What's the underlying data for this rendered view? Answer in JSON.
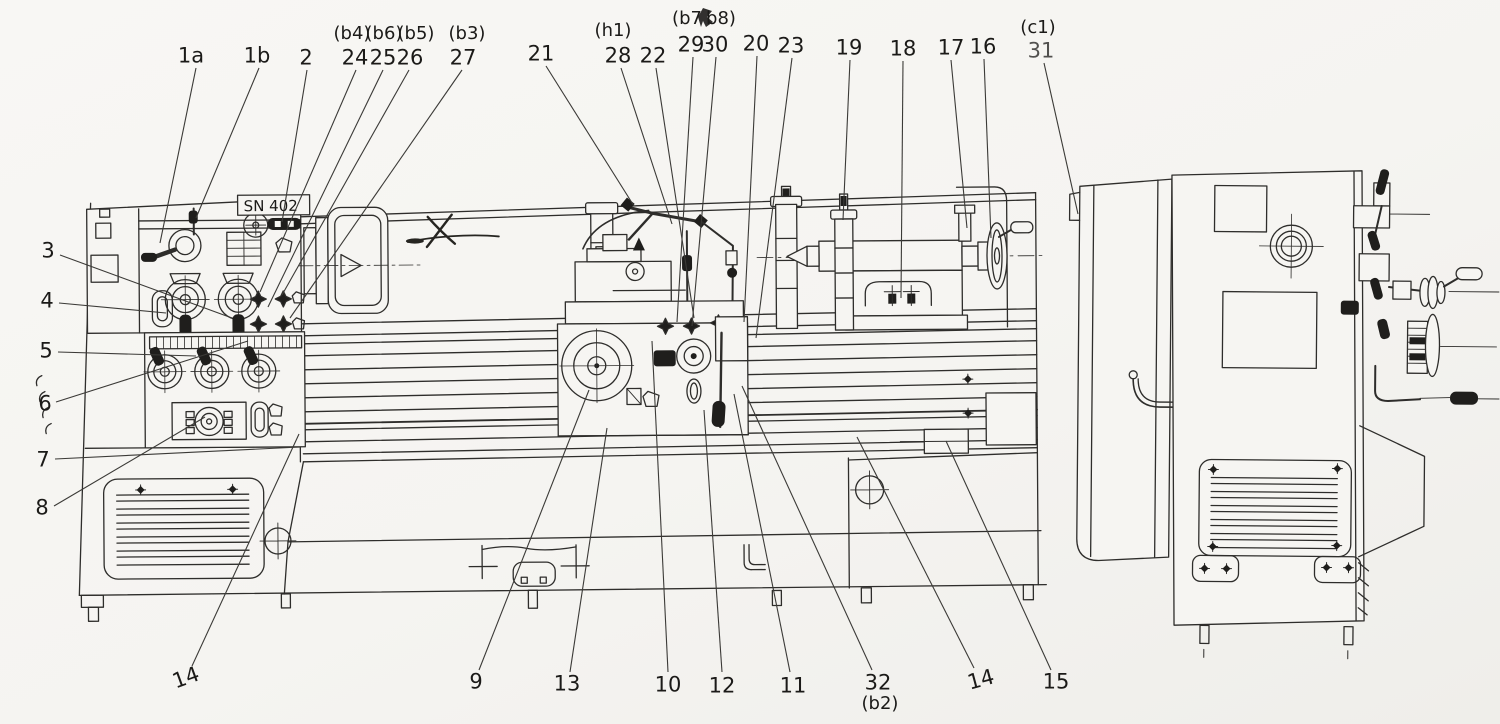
{
  "document": {
    "model_label": "SN 402"
  },
  "figure": {
    "paper_color": "#f6f5f2",
    "line_color": "#2e2d2b",
    "views": [
      "front-view",
      "end-view"
    ]
  },
  "callouts": [
    {
      "id": "1a",
      "text": "1a",
      "x": 191,
      "y": 56,
      "leader": [
        196,
        68,
        160,
        243
      ]
    },
    {
      "id": "1b",
      "text": "1b",
      "x": 257,
      "y": 56,
      "leader": [
        259,
        68,
        196,
        218
      ]
    },
    {
      "id": "2",
      "text": "2",
      "x": 306,
      "y": 58,
      "leader": [
        307,
        70,
        282,
        222
      ]
    },
    {
      "id": "b4",
      "text": "(b4)",
      "x": 352,
      "y": 34,
      "size": "sm"
    },
    {
      "id": "b6",
      "text": "(b6)",
      "x": 384,
      "y": 34,
      "size": "sm"
    },
    {
      "id": "b5",
      "text": "(b5)",
      "x": 416,
      "y": 34,
      "size": "sm"
    },
    {
      "id": "24",
      "text": "24",
      "x": 355,
      "y": 58,
      "leader": [
        356,
        70,
        260,
        292
      ]
    },
    {
      "id": "25",
      "text": "25",
      "x": 383,
      "y": 58,
      "leader": [
        383,
        70,
        268,
        307
      ]
    },
    {
      "id": "26",
      "text": "26",
      "x": 410,
      "y": 58,
      "leader": [
        409,
        70,
        282,
        295
      ]
    },
    {
      "id": "b3",
      "text": "(b3)",
      "x": 467,
      "y": 34,
      "size": "sm"
    },
    {
      "id": "27",
      "text": "27",
      "x": 463,
      "y": 58,
      "leader": [
        462,
        70,
        290,
        318
      ]
    },
    {
      "id": "21",
      "text": "21",
      "x": 541,
      "y": 54,
      "leader": [
        546,
        66,
        634,
        206
      ]
    },
    {
      "id": "h1",
      "text": "(h1)",
      "x": 613,
      "y": 31,
      "size": "sm"
    },
    {
      "id": "28",
      "text": "28",
      "x": 618,
      "y": 56,
      "leader": [
        621,
        68,
        672,
        224
      ]
    },
    {
      "id": "22",
      "text": "22",
      "x": 653,
      "y": 56,
      "leader": [
        656,
        68,
        694,
        318
      ]
    },
    {
      "id": "b7",
      "text": "(b7",
      "x": 687,
      "y": 19,
      "size": "sm"
    },
    {
      "id": "b8",
      "text": "b8)",
      "x": 721,
      "y": 19,
      "size": "sm"
    },
    {
      "id": "29",
      "text": "29",
      "x": 691,
      "y": 45,
      "leader": [
        693,
        57,
        677,
        322
      ]
    },
    {
      "id": "30",
      "text": "30",
      "x": 715,
      "y": 45,
      "leader": [
        716,
        57,
        692,
        326
      ]
    },
    {
      "id": "20",
      "text": "20",
      "x": 756,
      "y": 44,
      "leader": [
        757,
        56,
        744,
        322
      ]
    },
    {
      "id": "23",
      "text": "23",
      "x": 791,
      "y": 46,
      "leader": [
        792,
        58,
        756,
        338
      ]
    },
    {
      "id": "19",
      "text": "19",
      "x": 849,
      "y": 48,
      "leader": [
        850,
        60,
        843,
        220
      ]
    },
    {
      "id": "18",
      "text": "18",
      "x": 903,
      "y": 49,
      "leader": [
        903,
        61,
        901,
        298
      ]
    },
    {
      "id": "17",
      "text": "17",
      "x": 951,
      "y": 48,
      "leader": [
        951,
        60,
        967,
        228
      ]
    },
    {
      "id": "16",
      "text": "16",
      "x": 983,
      "y": 47,
      "leader": [
        984,
        59,
        991,
        238
      ]
    },
    {
      "id": "c1",
      "text": "(c1)",
      "x": 1038,
      "y": 28,
      "size": "sm"
    },
    {
      "id": "31",
      "text": "31",
      "x": 1041,
      "y": 51,
      "opacity": 0.75,
      "leader": [
        1044,
        63,
        1078,
        214
      ]
    },
    {
      "id": "3",
      "text": "3",
      "x": 48,
      "y": 251,
      "leader": [
        60,
        255,
        232,
        318
      ]
    },
    {
      "id": "4",
      "text": "4",
      "x": 47,
      "y": 301,
      "leader": [
        59,
        303,
        166,
        313
      ]
    },
    {
      "id": "5",
      "text": "5",
      "x": 46,
      "y": 351,
      "leader": [
        58,
        352,
        196,
        356
      ]
    },
    {
      "id": "6",
      "text": "6",
      "x": 45,
      "y": 404,
      "leader": [
        56,
        402,
        248,
        341
      ]
    },
    {
      "id": "7",
      "text": "7",
      "x": 43,
      "y": 460,
      "leader": [
        55,
        459,
        300,
        447
      ]
    },
    {
      "id": "8",
      "text": "8",
      "x": 42,
      "y": 508,
      "leader": [
        54,
        506,
        205,
        417
      ]
    },
    {
      "id": "14a",
      "text": "14",
      "x": 186,
      "y": 678,
      "rot": -20,
      "leader": [
        192,
        666,
        299,
        434
      ]
    },
    {
      "id": "9",
      "text": "9",
      "x": 476,
      "y": 682,
      "leader": [
        479,
        670,
        589,
        390
      ]
    },
    {
      "id": "13",
      "text": "13",
      "x": 567,
      "y": 684,
      "leader": [
        570,
        672,
        607,
        428
      ]
    },
    {
      "id": "10",
      "text": "10",
      "x": 668,
      "y": 685,
      "leader": [
        668,
        672,
        652,
        341
      ]
    },
    {
      "id": "12",
      "text": "12",
      "x": 722,
      "y": 686,
      "leader": [
        722,
        672,
        704,
        410
      ]
    },
    {
      "id": "11",
      "text": "11",
      "x": 793,
      "y": 686,
      "leader": [
        790,
        672,
        734,
        394
      ]
    },
    {
      "id": "32",
      "text": "32",
      "x": 878,
      "y": 683,
      "leader": [
        872,
        670,
        742,
        386
      ]
    },
    {
      "id": "b2",
      "text": "(b2)",
      "x": 880,
      "y": 704,
      "size": "sm"
    },
    {
      "id": "14b",
      "text": "14",
      "x": 981,
      "y": 680,
      "rot": -15,
      "leader": [
        974,
        668,
        857,
        437
      ]
    },
    {
      "id": "15",
      "text": "15",
      "x": 1056,
      "y": 682,
      "leader": [
        1051,
        670,
        946,
        441
      ]
    }
  ]
}
